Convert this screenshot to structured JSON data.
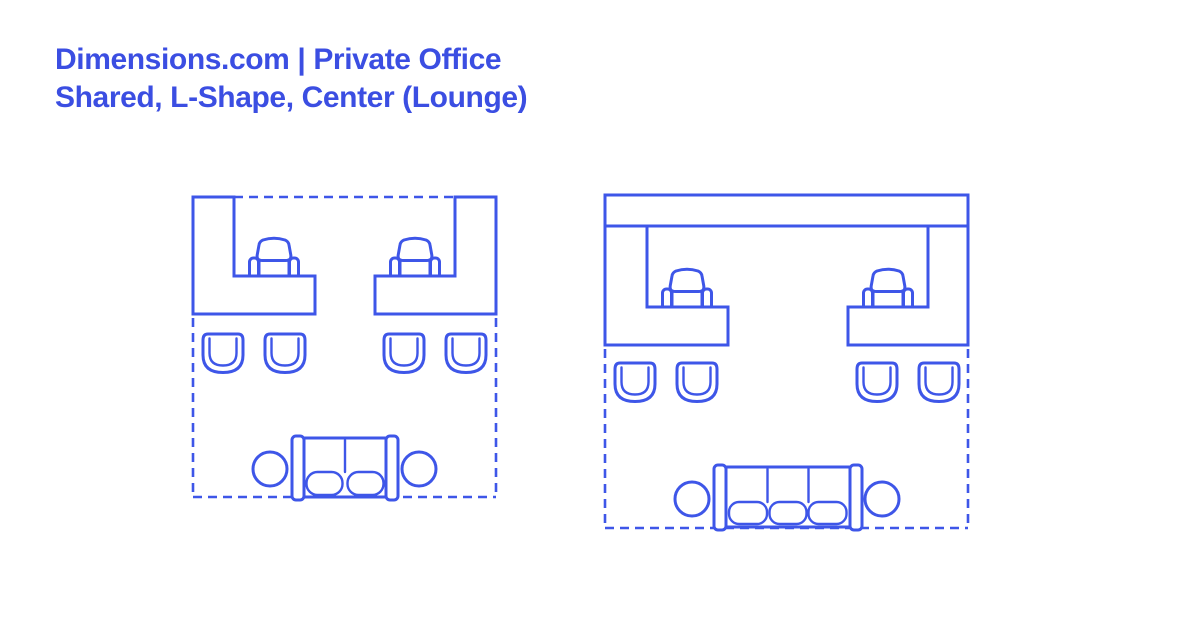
{
  "header": {
    "title_line1": "Dimensions.com | Private Office",
    "title_line2": "Shared, L-Shape, Center (Lounge)"
  },
  "colors": {
    "title_text": "#3B4EE2",
    "line_art": "#3E56E8",
    "background": "#FFFFFF"
  },
  "diagram": {
    "type": "floor-plan-line-drawing",
    "floorplans": [
      {
        "name": "shared-l-shape-office-compact",
        "desks": 2,
        "desk_shape": "L-shape",
        "task_chairs": 2,
        "guest_chairs": 4,
        "sofa_seats": 2,
        "round_side_tables": 2,
        "boundary": "dashed"
      },
      {
        "name": "shared-l-shape-office-wide",
        "desks": 2,
        "desk_shape": "L-shape with full-width back counter",
        "task_chairs": 2,
        "guest_chairs": 4,
        "sofa_seats": 3,
        "round_side_tables": 2,
        "boundary": "dashed"
      }
    ]
  }
}
